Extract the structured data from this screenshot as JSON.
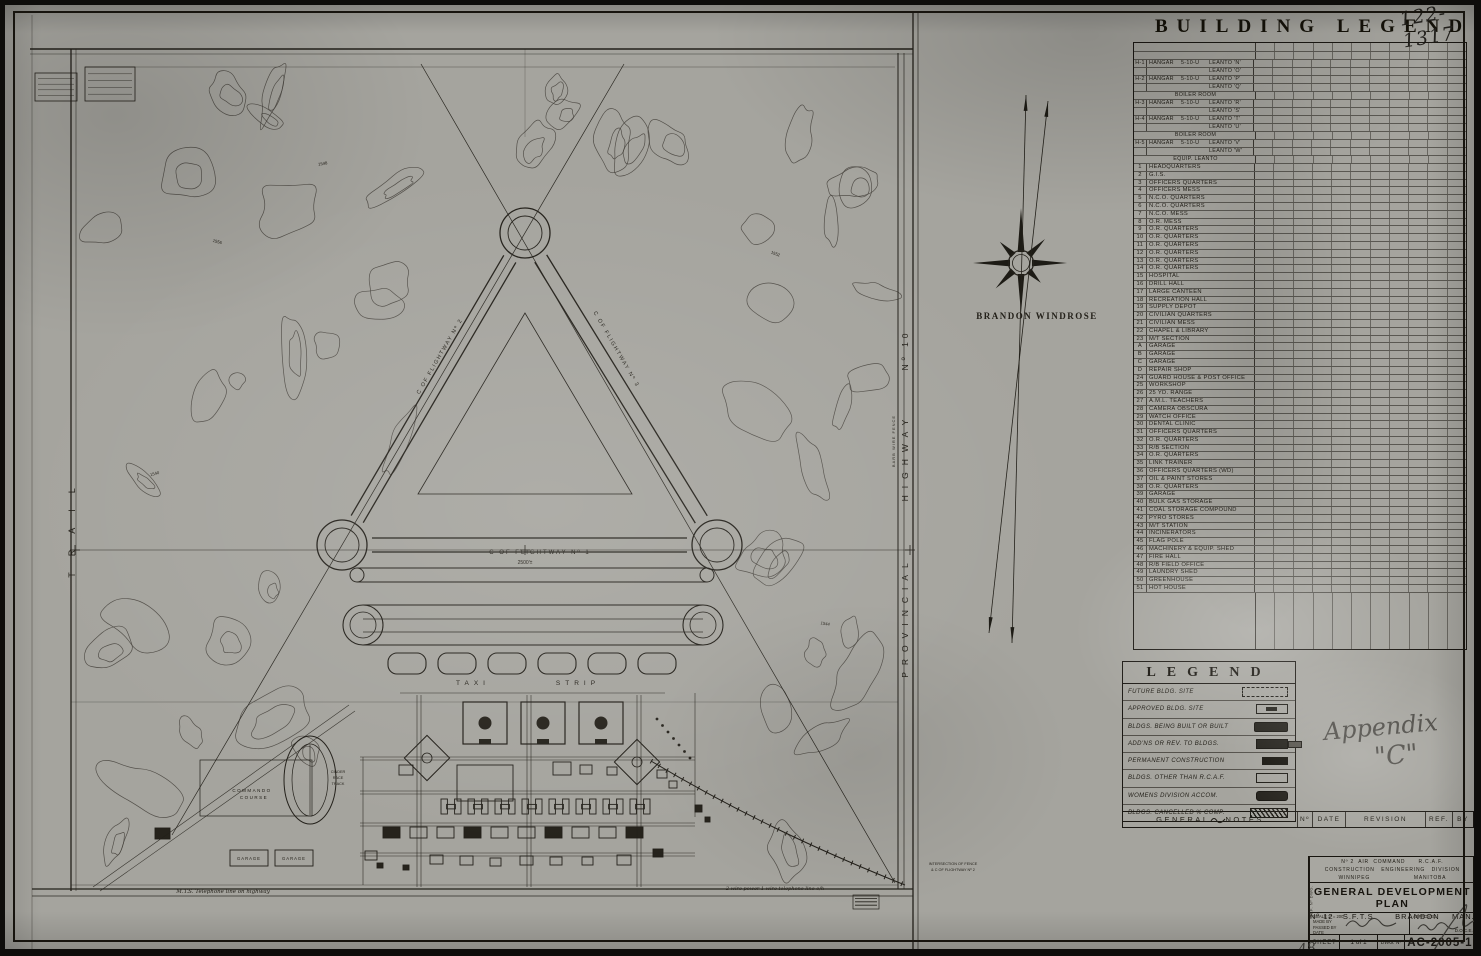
{
  "sheet": {
    "number_handwritten": "122-1317",
    "appendix_line1": "Appendix",
    "appendix_line2": "\"C\""
  },
  "building_legend": {
    "title": "BUILDING LEGEND",
    "hangar_rows": [
      [
        "H-1",
        "HANGAR",
        "5-10-U",
        "LEANTO 'N'"
      ],
      [
        "",
        "",
        "",
        "LEANTO 'O'"
      ],
      [
        "H-2",
        "HANGAR",
        "5-10-U",
        "LEANTO 'P'"
      ],
      [
        "",
        "",
        "",
        "LEANTO 'Q'"
      ],
      [
        "",
        "BOILER ROOM",
        "",
        ""
      ],
      [
        "H-3",
        "HANGAR",
        "5-10-U",
        "LEANTO 'R'"
      ],
      [
        "",
        "",
        "",
        "LEANTO 'S'"
      ],
      [
        "H-4",
        "HANGAR",
        "5-10-U",
        "LEANTO 'T'"
      ],
      [
        "",
        "",
        "",
        "LEANTO 'U'"
      ],
      [
        "",
        "BOILER ROOM",
        "",
        ""
      ],
      [
        "H-5",
        "HANGAR",
        "5-10-U",
        "LEANTO 'V'"
      ],
      [
        "",
        "",
        "",
        "LEANTO 'W'"
      ],
      [
        "",
        "EQUIP. LEANTO",
        "",
        ""
      ]
    ],
    "items": [
      [
        "1",
        "HEADQUARTERS"
      ],
      [
        "2",
        "G.I.S."
      ],
      [
        "3",
        "OFFICERS QUARTERS"
      ],
      [
        "4",
        "OFFICERS MESS"
      ],
      [
        "5",
        "N.C.O. QUARTERS"
      ],
      [
        "6",
        "N.C.O. QUARTERS"
      ],
      [
        "7",
        "N.C.O. MESS"
      ],
      [
        "8",
        "O.R. MESS"
      ],
      [
        "9",
        "O.R. QUARTERS"
      ],
      [
        "10",
        "O.R. QUARTERS"
      ],
      [
        "11",
        "O.R. QUARTERS"
      ],
      [
        "12",
        "O.R. QUARTERS"
      ],
      [
        "13",
        "O.R. QUARTERS"
      ],
      [
        "14",
        "O.R. QUARTERS"
      ],
      [
        "15",
        "HOSPITAL"
      ],
      [
        "16",
        "DRILL HALL"
      ],
      [
        "17",
        "LARGE CANTEEN"
      ],
      [
        "18",
        "RECREATION HALL"
      ],
      [
        "19",
        "SUPPLY DEPOT"
      ],
      [
        "20",
        "CIVILIAN QUARTERS"
      ],
      [
        "21",
        "CIVILIAN MESS"
      ],
      [
        "22",
        "CHAPEL & LIBRARY"
      ],
      [
        "23",
        "M/T SECTION"
      ],
      [
        "A",
        "GARAGE"
      ],
      [
        "B",
        "GARAGE"
      ],
      [
        "C",
        "GARAGE"
      ],
      [
        "D",
        "REPAIR SHOP"
      ],
      [
        "24",
        "GUARD HOUSE & POST OFFICE"
      ],
      [
        "25",
        "WORKSHOP"
      ],
      [
        "26",
        "25 YD. RANGE"
      ],
      [
        "27",
        "A.M.L. TEACHERS"
      ],
      [
        "28",
        "CAMERA OBSCURA"
      ],
      [
        "29",
        "WATCH OFFICE"
      ],
      [
        "30",
        "DENTAL CLINIC"
      ],
      [
        "31",
        "OFFICERS QUARTERS"
      ],
      [
        "32",
        "O.R. QUARTERS"
      ],
      [
        "33",
        "R/B SECTION"
      ],
      [
        "34",
        "O.R. QUARTERS"
      ],
      [
        "35",
        "LINK TRAINER"
      ],
      [
        "36",
        "OFFICERS QUARTERS (WD)"
      ],
      [
        "37",
        "OIL & PAINT STORES"
      ],
      [
        "38",
        "O.R. QUARTERS"
      ],
      [
        "39",
        "GARAGE"
      ],
      [
        "40",
        "BULK GAS STORAGE"
      ],
      [
        "41",
        "COAL STORAGE COMPOUND"
      ],
      [
        "42",
        "PYRO STORES"
      ],
      [
        "43",
        "M/T STATION"
      ],
      [
        "44",
        "INCINERATORS"
      ],
      [
        "45",
        "FLAG POLE"
      ],
      [
        "46",
        "MACHINERY & EQUIP. SHED"
      ],
      [
        "47",
        "FIRE HALL"
      ],
      [
        "48",
        "R/B FIELD OFFICE"
      ],
      [
        "49",
        "LAUNDRY SHED"
      ],
      [
        "50",
        "GREENHOUSE"
      ],
      [
        "51",
        "HOT HOUSE"
      ]
    ]
  },
  "legend_box": {
    "title": "LEGEND",
    "entries": [
      {
        "label": "FUTURE BLDG. SITE",
        "symbol": "dashed"
      },
      {
        "label": "APPROVED BLDG. SITE",
        "symbol": "approved"
      },
      {
        "label": "BLDGS. BEING BUILT OR BUILT",
        "symbol": "built"
      },
      {
        "label": "ADD'NS OR REV. TO BLDGS.",
        "symbol": "addition"
      },
      {
        "label": "PERMANENT CONSTRUCTION",
        "symbol": "permanent"
      },
      {
        "label": "BLDGS. OTHER THAN R.C.A.F.",
        "symbol": "outline"
      },
      {
        "label": "WOMENS DIVISION ACCOM.",
        "symbol": "womens"
      },
      {
        "label": "BLDGS. CANCELLED % COMP.",
        "symbol": "cancelled"
      }
    ]
  },
  "notes_bar": {
    "left": "GENERAL",
    "mid": "NOTES",
    "cols": [
      "Nº",
      "DATE",
      "REVISION",
      "REF.",
      "BY"
    ]
  },
  "title_block": {
    "org_line1": "Nº 2  AIR  COMMAND      R.C.A.F.",
    "org_line2": "CONSTRUCTION   ENGINEERING   DIVISION",
    "org_line3": "WINNIPEG                    MANITOBA",
    "title": "GENERAL DEVELOPMENT PLAN",
    "subtitle": "Nº 12   S.F.T.S.      BRANDON    MAN.",
    "scale": "SCALE   1\" = 200'",
    "made_by": "MADE BY",
    "passed_by": "PASSED BY",
    "date": "DATE",
    "approved": "APPROVED",
    "approved_sig": "D.O.C.E.",
    "sheet_label": "SHEET",
    "sheet_value": "1 of 1",
    "dwg_label": "DWG. Nº",
    "dwg_value": "AC-2005-1",
    "side_label": "REF. Nº  DWG.",
    "pencil_mark": "48"
  },
  "map": {
    "windrose_label": "BRANDON  WINDROSE",
    "labels": [
      {
        "t": "TRAIL",
        "x": 70,
        "y": 520,
        "r": -90,
        "s": 9,
        "ls": 16
      },
      {
        "t": "PROVINCIAL",
        "x": 903,
        "y": 612,
        "r": -90,
        "s": 8.5,
        "ls": 7
      },
      {
        "t": "HIGHWAY",
        "x": 903,
        "y": 452,
        "r": -90,
        "s": 8.5,
        "ls": 7
      },
      {
        "t": "Nº 10",
        "x": 903,
        "y": 345,
        "r": -90,
        "s": 8.5,
        "ls": 4
      },
      {
        "t": "BARB  WIRE  FENCE",
        "x": 890,
        "y": 436,
        "r": -90,
        "s": 4,
        "ls": 1
      },
      {
        "t": "BRANDON  WINDROSE",
        "x": 1032,
        "y": 314,
        "s": 9,
        "f": 1,
        "b": 1,
        "ls": 1.5
      },
      {
        "t": "TAXI",
        "x": 468,
        "y": 680,
        "s": 6.5,
        "ls": 5
      },
      {
        "t": "STRIP",
        "x": 573,
        "y": 680,
        "s": 6.5,
        "ls": 5
      },
      {
        "t": "C  OF  FLIGHTWAY  Nº 1",
        "x": 535,
        "y": 549,
        "s": 6,
        "ls": 2
      },
      {
        "t": "2500'±",
        "x": 520,
        "y": 559,
        "s": 5
      },
      {
        "t": "C  OF  FLIGHTWAY  Nº 2",
        "x": 436,
        "y": 352,
        "r": -60,
        "s": 5.5,
        "ls": 1.5
      },
      {
        "t": "C  OF  FLIGHTWAY  Nº 3",
        "x": 610,
        "y": 345,
        "r": 60,
        "s": 5.5,
        "ls": 1.5
      },
      {
        "t": "COMMANDO",
        "x": 247,
        "y": 787,
        "s": 4.5,
        "ls": 1.5
      },
      {
        "t": "COURSE",
        "x": 249,
        "y": 794,
        "s": 4.5,
        "ls": 1.5
      },
      {
        "t": "CINDER",
        "x": 333,
        "y": 768,
        "s": 3.8
      },
      {
        "t": "RACE",
        "x": 333,
        "y": 774,
        "s": 3.8
      },
      {
        "t": "TRACK",
        "x": 333,
        "y": 780,
        "s": 3.8
      },
      {
        "t": "GARAGE",
        "x": 244,
        "y": 855,
        "s": 4.2,
        "ls": 1
      },
      {
        "t": "GARAGE",
        "x": 289,
        "y": 855,
        "s": 4.2,
        "ls": 1
      },
      {
        "t": "M.T.S.  Telephone  line  on  highway",
        "x": 218,
        "y": 888,
        "s": 5.5,
        "i": 1
      },
      {
        "t": "2 wire power  1 wire telephone line o/h",
        "x": 770,
        "y": 885,
        "s": 5,
        "i": 1
      },
      {
        "t": "INTERSECTION OF FENCE",
        "x": 948,
        "y": 860,
        "s": 3.8
      },
      {
        "t": "& C OF FLIGHTWAY Nº 2",
        "x": 948,
        "y": 866,
        "s": 3.8
      },
      {
        "t": "1556",
        "x": 212,
        "y": 238,
        "s": 4.2,
        "r": 15
      },
      {
        "t": "1548",
        "x": 318,
        "y": 160,
        "s": 4.2,
        "r": -10
      },
      {
        "t": "1552",
        "x": 770,
        "y": 250,
        "s": 4.2,
        "r": 20
      },
      {
        "t": "1540",
        "x": 150,
        "y": 470,
        "s": 4.2,
        "r": -15
      },
      {
        "t": "1544",
        "x": 820,
        "y": 620,
        "s": 4.2,
        "r": 10
      }
    ]
  },
  "ink": "#23201a"
}
